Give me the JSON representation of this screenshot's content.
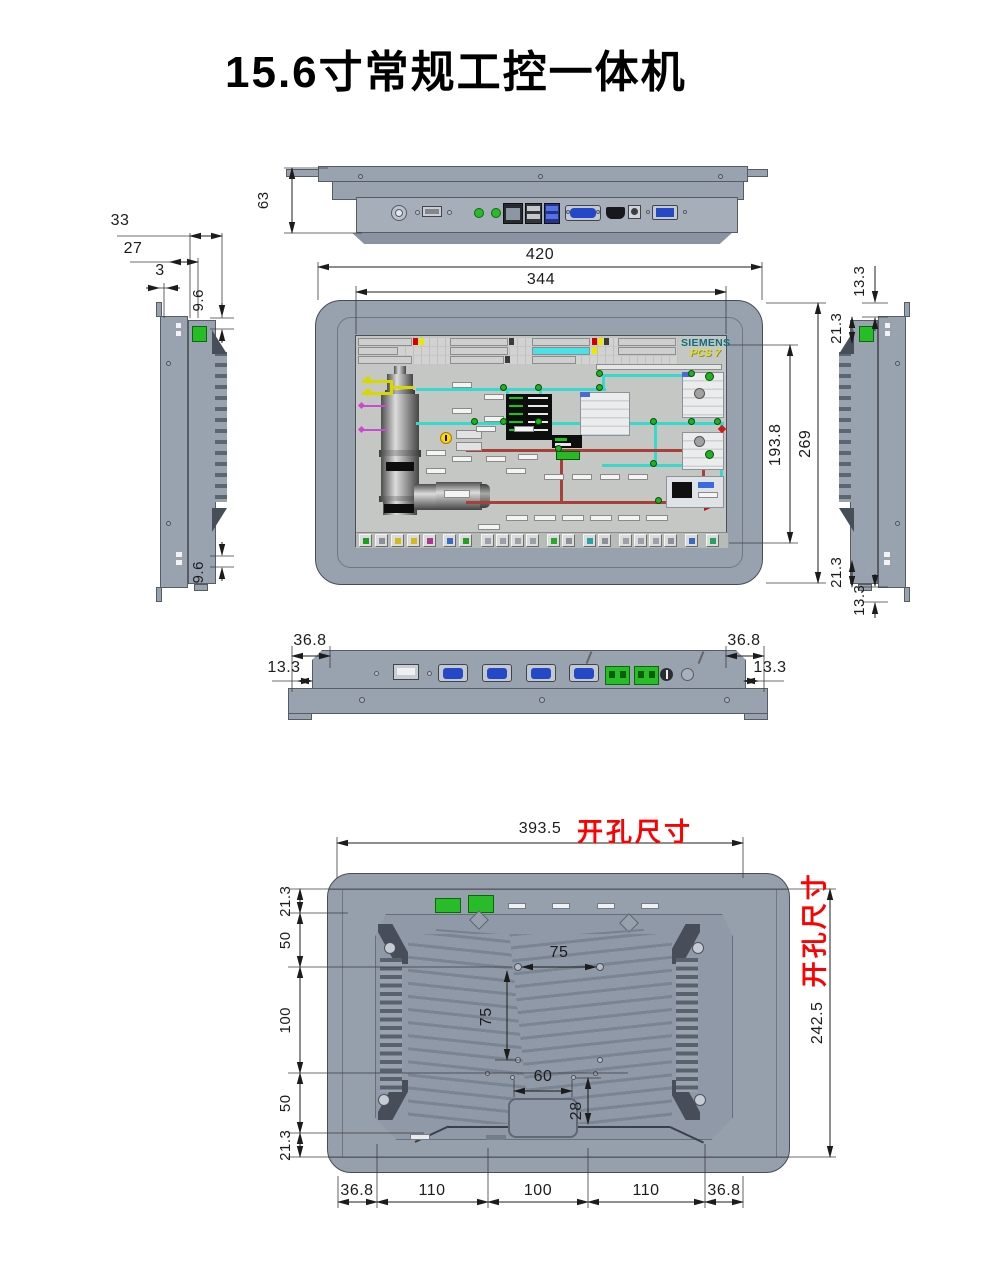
{
  "title": "15.6寸常规工控一体机",
  "screen": {
    "brand": "SIEMENS",
    "product": "PCS 7"
  },
  "colors": {
    "body_metal": "#99a3b0",
    "connector_green": "#28bc28",
    "port_blue": "#2448c8",
    "cutout_red": "#fe0000",
    "siemens_teal": "#0d6e7d",
    "pcs7_yellow": "#e2e21e",
    "pipe_cyan": "#38d8cc",
    "pipe_yellow": "#d8d800",
    "pipe_magenta": "#cc4ad2",
    "pipe_red": "#a84038"
  },
  "dims": {
    "top": {
      "depth": "63"
    },
    "left_side": {
      "total": "33",
      "box": "27",
      "panel": "3",
      "top_offset": "9.6",
      "bottom_offset": "9.6"
    },
    "front": {
      "width": "420",
      "screen_width": "344",
      "height": "269",
      "screen_height": "193.8"
    },
    "right_side": {
      "top_flange": "13.3",
      "top_inset": "21.3",
      "bottom_inset": "21.3",
      "bottom_flange": "13.3"
    },
    "bottom": {
      "left_inset": "36.8",
      "right_inset": "36.8",
      "left_flange": "13.3",
      "right_flange": "13.3"
    },
    "rear": {
      "cutout_label": "开孔尺寸",
      "cutout_width": "393.5",
      "cutout_height": "242.5",
      "left_chain": [
        "21.3",
        "50",
        "100",
        "50",
        "21.3"
      ],
      "bottom_chain": [
        "36.8",
        "110",
        "100",
        "110",
        "36.8"
      ],
      "vesa_width": "75",
      "vesa_height": "75",
      "lower_hole_width": "60",
      "lower_hole_height": "28"
    }
  }
}
